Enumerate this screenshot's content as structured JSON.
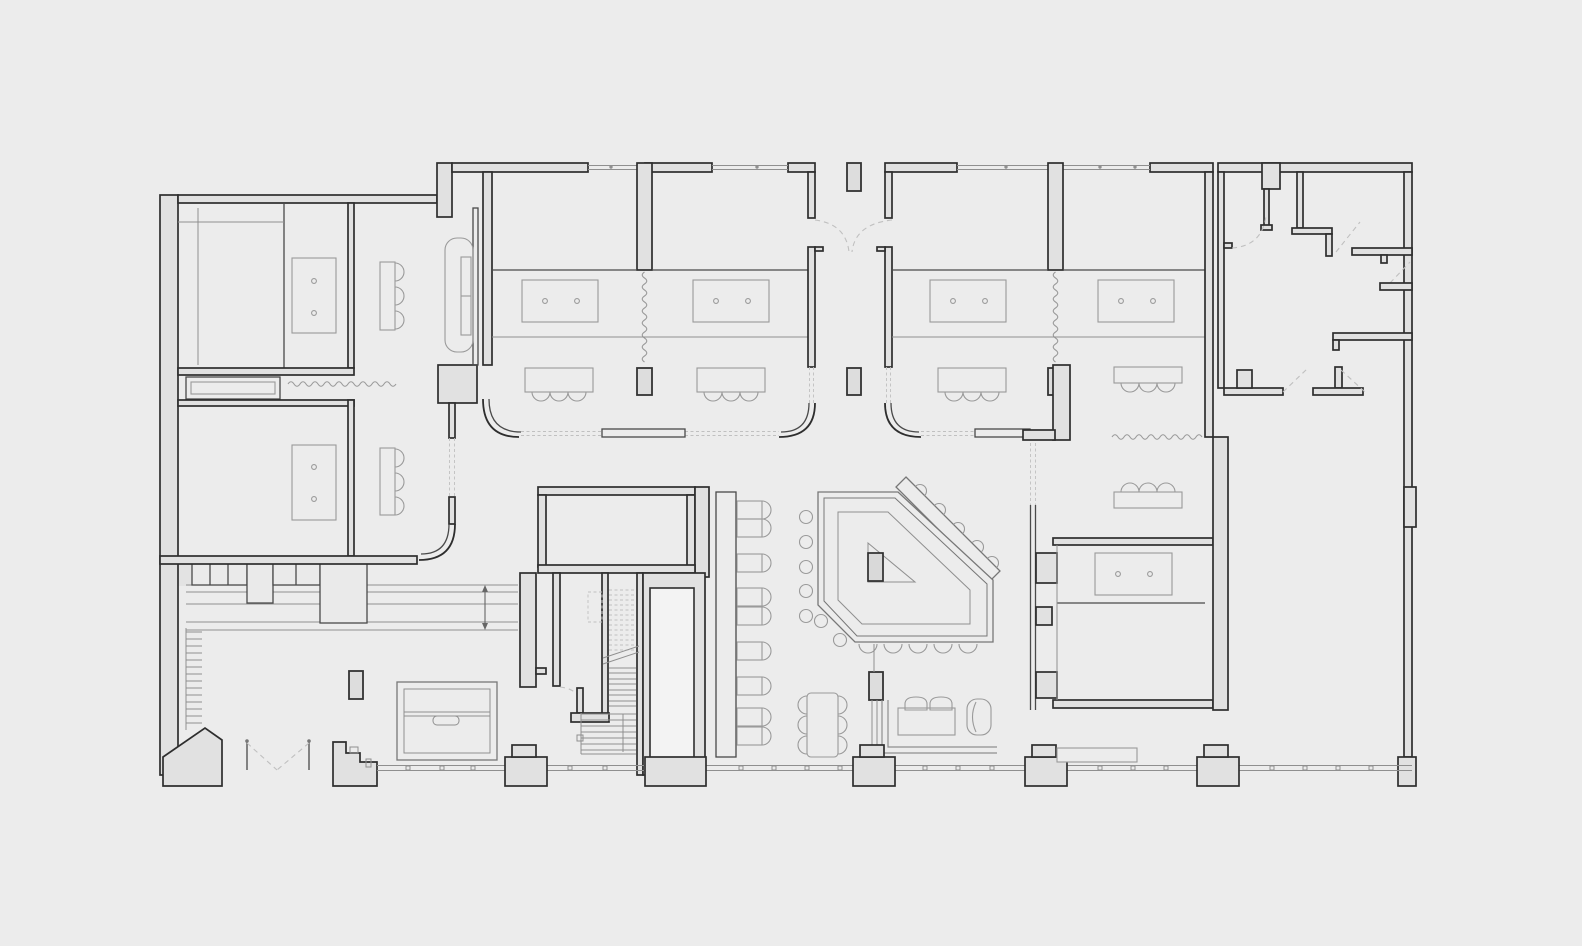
{
  "page": {
    "kind": "architectural floor plan line drawing",
    "visible_text": [],
    "notes": "monochrome plan of a hostel/restaurant level: guest units with beds and seat groups along the top, entry vestibules, bar with angled counter and stools, booth banquette, staircase core, reception lobby with coat rack and wardrobe counter, large empty hall at right, glazed facades with mullion dots top and bottom"
  },
  "drawing": {
    "type": "floor-plan",
    "colors": {
      "bg": "#ececec",
      "wallFill": "#e1e1e1",
      "wallStroke": "#2e2e2e",
      "medium": "#4a4a4a",
      "furn": "#9a9a9a",
      "dash": "#c0c0c0",
      "light": "#8f8f8f",
      "shaft": "#f3f3f3"
    },
    "inventory": {
      "beds": 7,
      "pillow_dots_per_bed": 2,
      "tables_with_seats": 9,
      "booth_chairs": 9,
      "bar_counter": 1,
      "bar_stools_round": 5,
      "bar_stools_half": 12,
      "sofa": 1,
      "staircase_flights": 2,
      "elevator_shaft": 1,
      "reception_desk": 1,
      "entrance_double_doors": 2,
      "coat_rack_hooks": 14,
      "wardrobe_locker_cells": 7,
      "freestanding_columns": 6,
      "curtain_zigzags": 4,
      "door_swing_arcs_dashed": 10
    }
  }
}
